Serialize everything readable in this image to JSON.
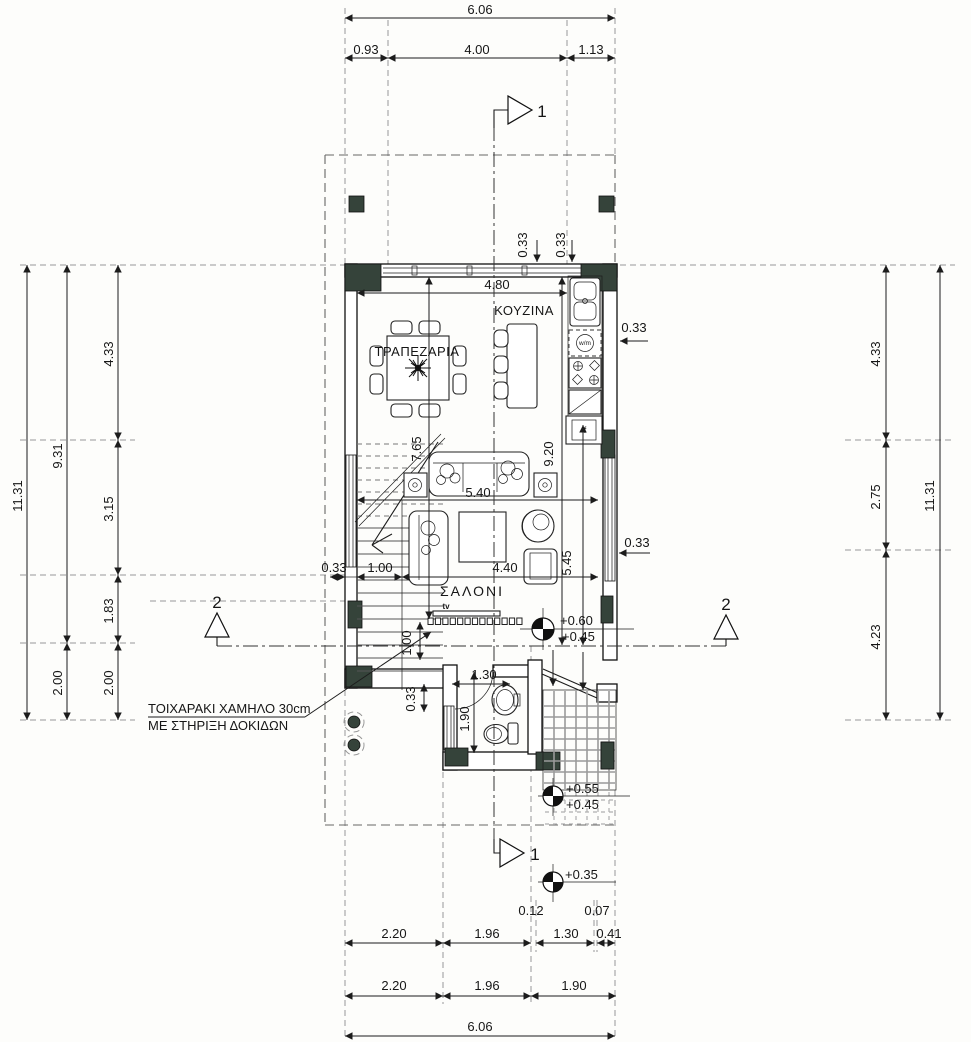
{
  "drawing": {
    "type": "ground-floor-plan",
    "rooms": {
      "dining": "ΤΡΑΠΕΖΑΡΙΑ",
      "kitchen": "ΚΟΥΖΙΝΑ",
      "living": "ΣΑΛΟΝΙ"
    },
    "fixtures": {
      "tv": "tv",
      "washing_machine": "w/m",
      "fridge": "f"
    },
    "note": {
      "line1": "ΤΟΙΧΑΡΑΚΙ ΧΑΜΗΛΟ 30cm",
      "line2": "ΜΕ ΣΤΗΡΙΞΗ ΔΟΚΙΔΩΝ"
    },
    "sections": {
      "top": "1",
      "bottom": "1",
      "left": "2",
      "right": "2"
    },
    "levels": {
      "living_upper": "+0.60",
      "living_lower": "+0.45",
      "porch_upper": "+0.55",
      "porch_lower": "+0.45",
      "garden": "+0.35"
    },
    "overall": {
      "width_m": "6.06",
      "depth_m": "11.31"
    },
    "colors": {
      "line": "#1c1c1c",
      "dashed": "#989898",
      "column_fill": "#35433a",
      "tile": "#9a9a9a"
    },
    "dimension_labels": [
      {
        "t": "6.06",
        "x": 480,
        "y": 14
      },
      {
        "t": "0.93",
        "x": 366,
        "y": 54
      },
      {
        "t": "4.00",
        "x": 477,
        "y": 54
      },
      {
        "t": "1.13",
        "x": 591,
        "y": 54
      },
      {
        "t": "11.31",
        "x": 22,
        "y": 496,
        "r": -90
      },
      {
        "t": "9.31",
        "x": 62,
        "y": 456,
        "r": -90
      },
      {
        "t": "2.00",
        "x": 62,
        "y": 683,
        "r": -90
      },
      {
        "t": "4.33",
        "x": 113,
        "y": 354,
        "r": -90
      },
      {
        "t": "3.15",
        "x": 113,
        "y": 509,
        "r": -90
      },
      {
        "t": "1.83",
        "x": 113,
        "y": 611,
        "r": -90
      },
      {
        "t": "2.00",
        "x": 113,
        "y": 683,
        "r": -90
      },
      {
        "t": "4.33",
        "x": 880,
        "y": 354,
        "r": -90
      },
      {
        "t": "2.75",
        "x": 880,
        "y": 497,
        "r": -90
      },
      {
        "t": "4.23",
        "x": 880,
        "y": 637,
        "r": -90
      },
      {
        "t": "11.31",
        "x": 934,
        "y": 496,
        "r": -90
      },
      {
        "t": "0.33",
        "x": 527,
        "y": 245,
        "r": -90
      },
      {
        "t": "0.33",
        "x": 565,
        "y": 245,
        "r": -90
      },
      {
        "t": "4.80",
        "x": 497,
        "y": 289
      },
      {
        "t": "0.33",
        "x": 634,
        "y": 332
      },
      {
        "t": "7.65",
        "x": 421,
        "y": 449,
        "r": -90
      },
      {
        "t": "9.20",
        "x": 553,
        "y": 454,
        "r": -90
      },
      {
        "t": "5.40",
        "x": 478,
        "y": 497
      },
      {
        "t": "0.33",
        "x": 637,
        "y": 547
      },
      {
        "t": "5.45",
        "x": 571,
        "y": 563,
        "r": -90
      },
      {
        "t": "0.33",
        "x": 334,
        "y": 572
      },
      {
        "t": "1.00",
        "x": 380,
        "y": 572
      },
      {
        "t": "4.40",
        "x": 505,
        "y": 572
      },
      {
        "t": "1.00",
        "x": 411,
        "y": 643,
        "r": -90
      },
      {
        "t": "0.33",
        "x": 415,
        "y": 699,
        "r": -90
      },
      {
        "t": "1.30",
        "x": 484,
        "y": 679
      },
      {
        "t": "1.90",
        "x": 469,
        "y": 719,
        "r": -90
      },
      {
        "t": "2.20",
        "x": 394,
        "y": 938
      },
      {
        "t": "1.96",
        "x": 487,
        "y": 938
      },
      {
        "t": "0.12",
        "x": 531,
        "y": 915
      },
      {
        "t": "1.30",
        "x": 566,
        "y": 938
      },
      {
        "t": "0.07",
        "x": 597,
        "y": 915
      },
      {
        "t": "0.41",
        "x": 609,
        "y": 938
      },
      {
        "t": "2.20",
        "x": 394,
        "y": 990
      },
      {
        "t": "1.96",
        "x": 487,
        "y": 990
      },
      {
        "t": "1.90",
        "x": 574,
        "y": 990
      },
      {
        "t": "6.06",
        "x": 480,
        "y": 1031
      }
    ]
  }
}
